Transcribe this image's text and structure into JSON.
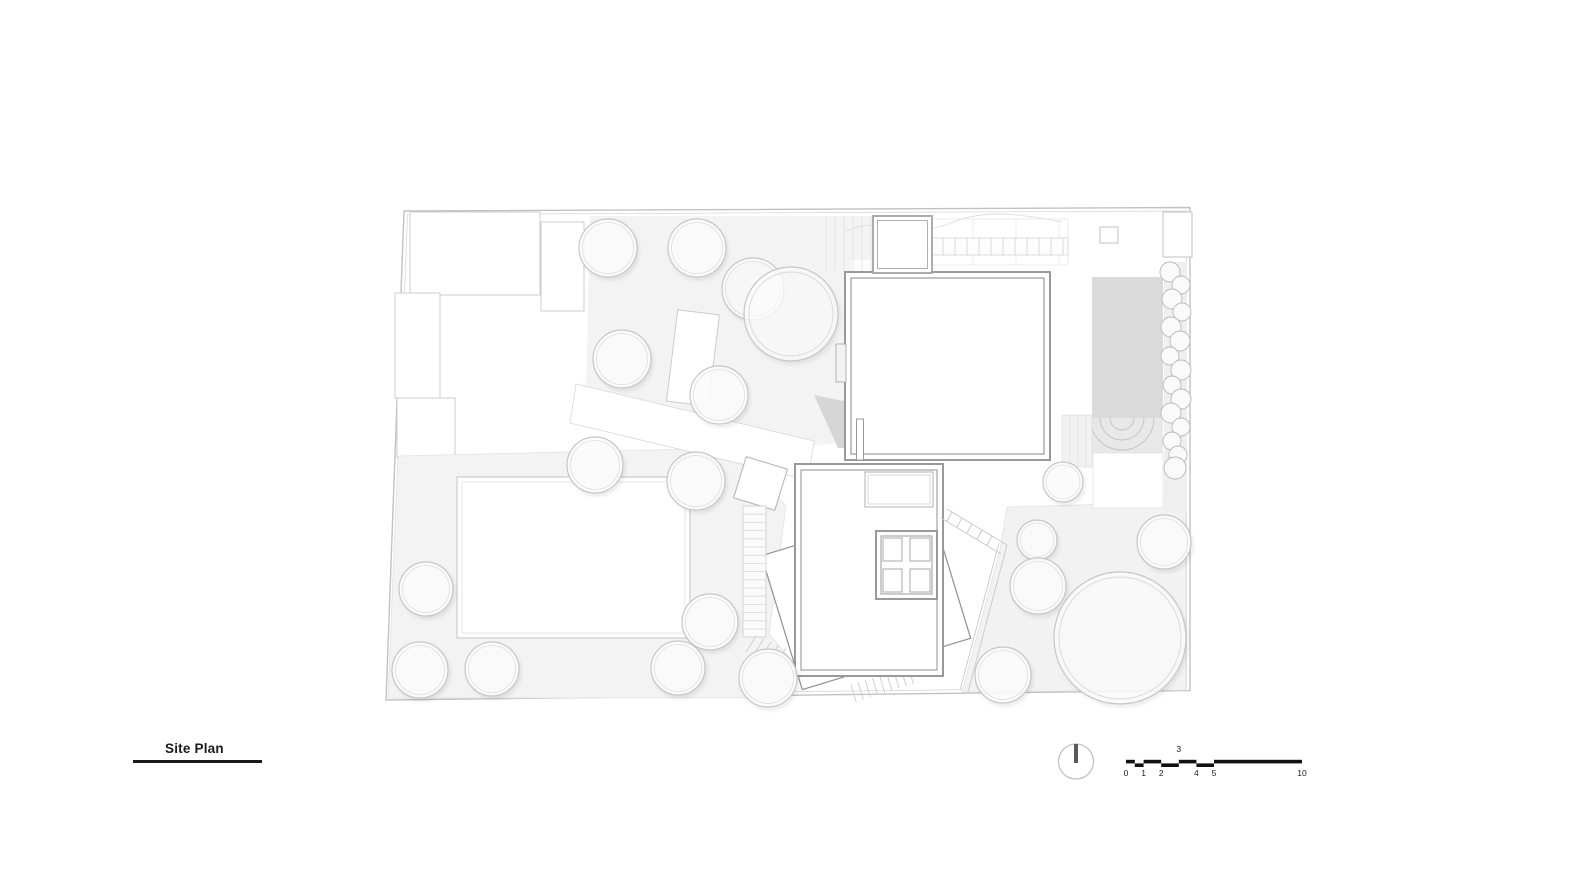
{
  "title": {
    "label": "Site Plan"
  },
  "scale_bar": {
    "labels_below": [
      "0",
      "1",
      "2",
      "4",
      "5",
      "10"
    ],
    "label_above": "3",
    "units": "meters"
  },
  "north_arrow": {
    "symbol": "circle-with-vertical-bar"
  },
  "colors": {
    "paper": "#ffffff",
    "line_light": "#c9c9c9",
    "line_building": "#999999",
    "line_dark": "#1a1a1a",
    "fill_garden": "#f3f3f3",
    "fill_pool": "#dadada",
    "fill_shadow": "#d6d6d6"
  },
  "elements": [
    "site-boundary",
    "neighbor-buildings",
    "garden-area",
    "lawn-area",
    "rear-garden-area",
    "garden-path",
    "main-house",
    "main-house-entry",
    "pergola-strip",
    "deck-boards",
    "swimming-pool",
    "pool-steps-arcs",
    "pool-deck",
    "hedge-shrubs",
    "guest-house",
    "guest-house-skylight",
    "guest-house-window",
    "guest-house-lower-level",
    "exterior-stair",
    "stair-landing",
    "stair-fan-steps",
    "garden-ramp",
    "planter",
    "trees",
    "north-arrow",
    "scale-bar"
  ]
}
